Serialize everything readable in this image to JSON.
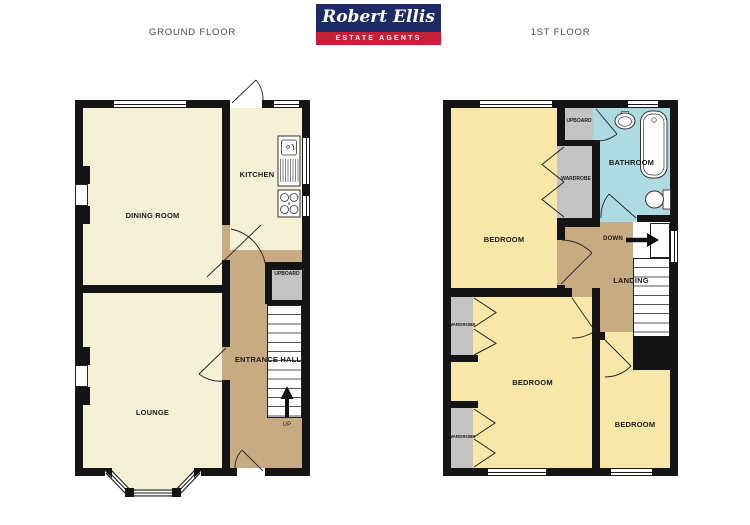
{
  "header": {
    "logo_line1": "Robert Ellis",
    "logo_line2": "ESTATE AGENTS",
    "ground_label": "GROUND FLOOR",
    "first_label": "1ST FLOOR"
  },
  "colors": {
    "logo_navy": "#1e2a66",
    "logo_red": "#c42136",
    "room_cream": "#f5f1d6",
    "bedroom_yellow": "#f7e7a8",
    "hall_tan": "#c9ab83",
    "bathroom_blue": "#aedbe2",
    "cupboard_gray": "#c3c3c3",
    "wall": "#141414"
  },
  "ground": {
    "dining": "DINING ROOM",
    "kitchen": "KITCHEN",
    "cupboard": "UPBOARD",
    "hall": "ENTRANCE HALL",
    "lounge": "LOUNGE",
    "up": "UP"
  },
  "first": {
    "bedroom1": "BEDROOM",
    "bathroom": "BATHROOM",
    "cupboard": "UPBOARD",
    "wardrobe_top": "WARDROBE",
    "down": "DOWN",
    "landing": "LANDING",
    "bedroom2": "BEDROOM",
    "bedroom3": "BEDROOM",
    "wardrobe_left1": "WARDROBE",
    "wardrobe_left2": "WARDROBE"
  }
}
